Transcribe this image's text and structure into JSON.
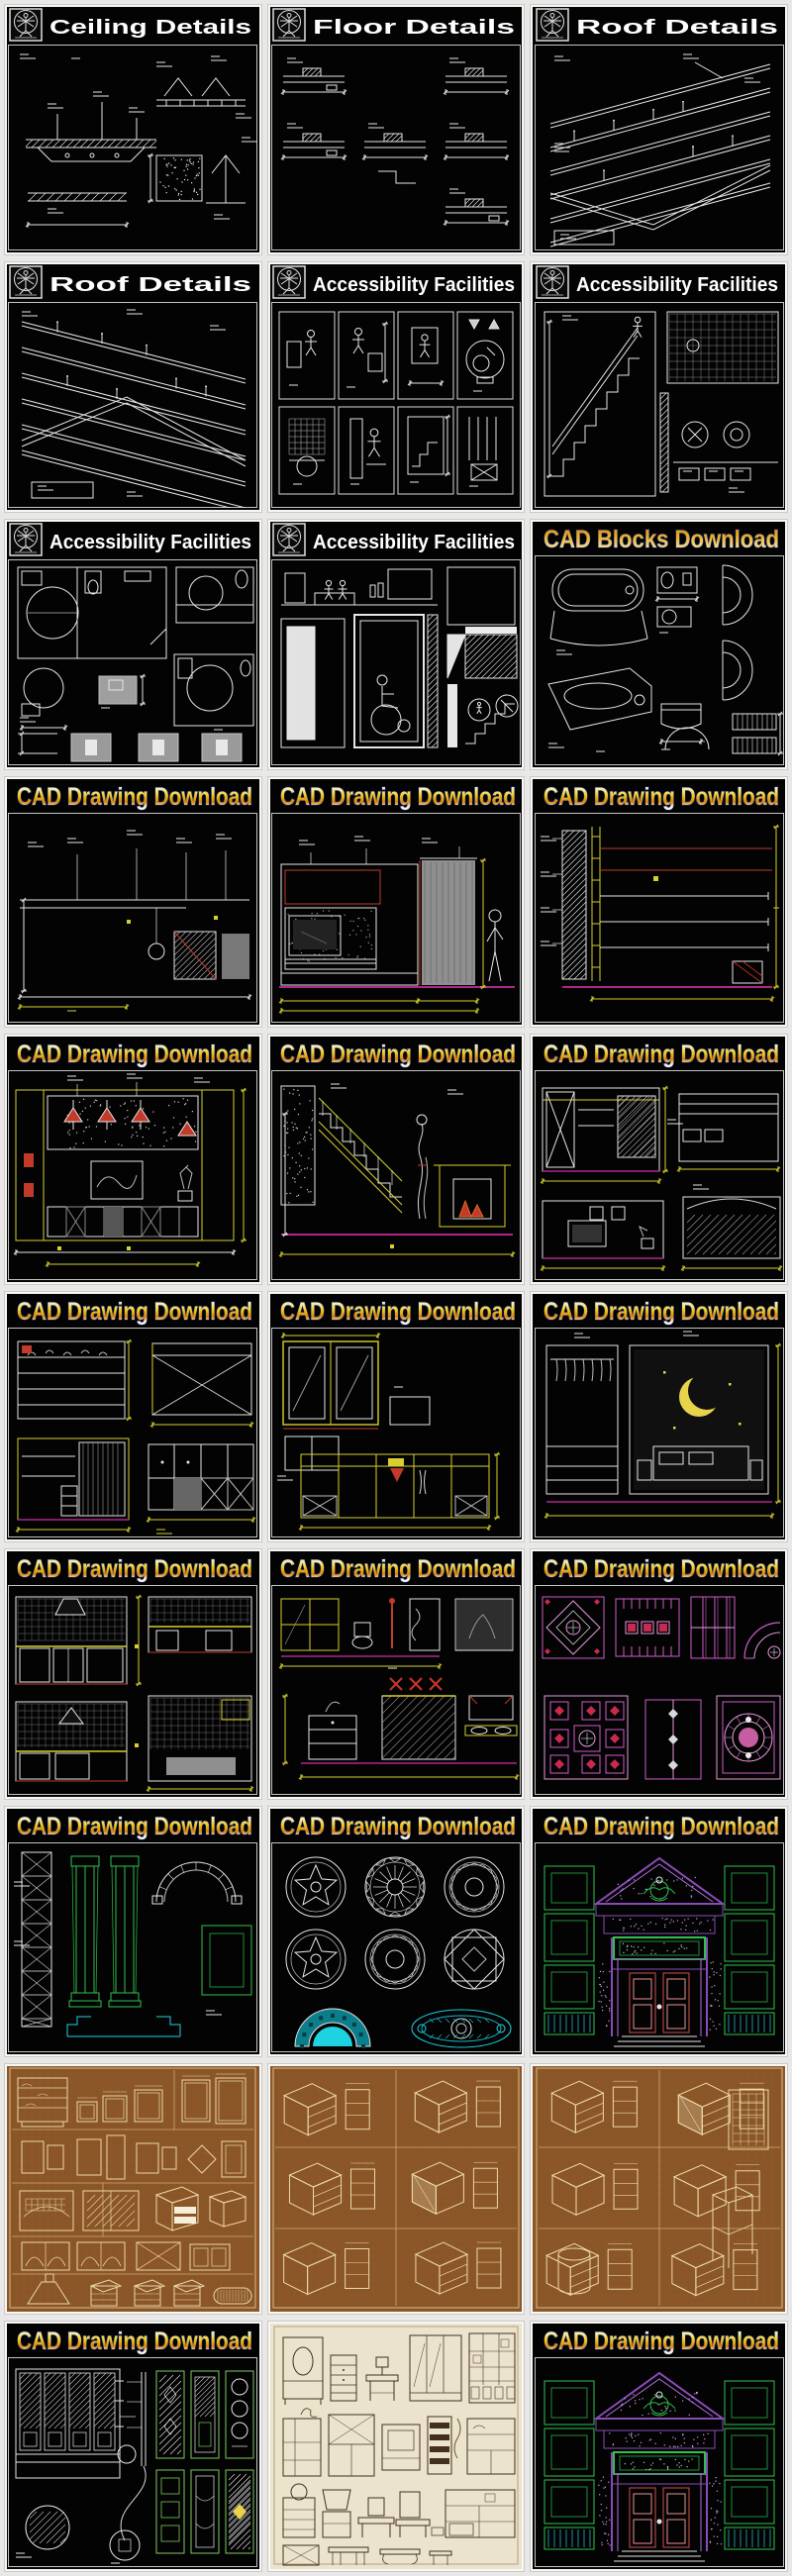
{
  "page": {
    "background": "#e9e8e6",
    "columns": 3,
    "rows": 10,
    "tile_count": 30
  },
  "palette": {
    "tile_bg_dark": "#030303",
    "tile_bg_brown": "#8a5527",
    "tile_bg_cream": "#ece3cd",
    "tile_border": "#f7f7f5",
    "tile_edge": "#bdbdbd",
    "line_white": "#e6e6e6",
    "line_gray": "#9a9a9a",
    "cad_yellow": "#d6cf2e",
    "cad_red": "#c8362a",
    "cad_magenta": "#b0268c",
    "cad_pink": "#cf5ec8",
    "cad_pink_light": "#e59ade",
    "cad_green": "#2fc14c",
    "cad_cyan": "#1ed2e2",
    "cad_purple": "#8a4bb8",
    "door_red": "#cf4f4f",
    "brown_line": "#ecd9a8",
    "brown_grid": "#94612e",
    "brown_divider": "#cfa96f",
    "cream_line": "#42301c",
    "title_white": "#ffffff",
    "title_outline": "#1b2a6e",
    "moon_yellow": "#e8d44a",
    "curtain_gray": "#8f8f8f"
  },
  "logo": {
    "name": "architect-logo",
    "shape": "vitruvian-man-in-square"
  },
  "tiles": [
    {
      "title": "Ceiling Details",
      "header": "logo",
      "art": "ceiling",
      "bg": "dark"
    },
    {
      "title": "Floor Details",
      "header": "logo",
      "art": "floor",
      "bg": "dark"
    },
    {
      "title": "Roof Details",
      "header": "logo",
      "art": "roofIso",
      "bg": "dark"
    },
    {
      "title": "Roof Details",
      "header": "logo",
      "art": "roofIso2",
      "bg": "dark"
    },
    {
      "title": "Accessibility Facilities",
      "header": "logo",
      "art": "accessPanels",
      "bg": "dark"
    },
    {
      "title": "Accessibility Facilities",
      "header": "logo",
      "art": "accessStairs",
      "bg": "dark"
    },
    {
      "title": "Accessibility Facilities",
      "header": "logo",
      "art": "accessPlan",
      "bg": "dark"
    },
    {
      "title": "Accessibility Facilities",
      "header": "logo",
      "art": "accessLift",
      "bg": "dark"
    },
    {
      "title": "CAD Blocks Download",
      "header": "gradientBlocks",
      "art": "blocks",
      "bg": "dark"
    },
    {
      "title": "CAD Drawing Download",
      "header": "gradient",
      "art": "elevSparse",
      "bg": "dark"
    },
    {
      "title": "CAD Drawing Download",
      "header": "gradient",
      "art": "elevTV",
      "bg": "dark"
    },
    {
      "title": "CAD Drawing Download",
      "header": "gradient",
      "art": "elevSection",
      "bg": "dark"
    },
    {
      "title": "CAD Drawing Download",
      "header": "gradient",
      "art": "elevLamps",
      "bg": "dark"
    },
    {
      "title": "CAD Drawing Download",
      "header": "gradient",
      "art": "stairHall",
      "bg": "dark"
    },
    {
      "title": "CAD Drawing Download",
      "header": "gradient",
      "art": "elevBedroom",
      "bg": "dark"
    },
    {
      "title": "CAD Drawing Download",
      "header": "gradient",
      "art": "elevCabinets",
      "bg": "dark"
    },
    {
      "title": "CAD Drawing Download",
      "header": "gradient",
      "art": "elevWardrobe",
      "bg": "dark"
    },
    {
      "title": "CAD Drawing Download",
      "header": "gradient",
      "art": "elevMoon",
      "bg": "dark"
    },
    {
      "title": "CAD Drawing Download",
      "header": "gradient",
      "art": "kitchen",
      "bg": "dark"
    },
    {
      "title": "CAD Drawing Download",
      "header": "gradient",
      "art": "bathroom",
      "bg": "dark"
    },
    {
      "title": "CAD Drawing Download",
      "header": "gradient",
      "art": "ceilingPlans",
      "bg": "dark"
    },
    {
      "title": "CAD Drawing Download",
      "header": "gradient",
      "art": "columns",
      "bg": "dark"
    },
    {
      "title": "CAD Drawing Download",
      "header": "gradient",
      "art": "medallions",
      "bg": "dark"
    },
    {
      "title": "CAD Drawing Download",
      "header": "gradient",
      "art": "facade",
      "bg": "dark"
    },
    {
      "title": "",
      "header": "none",
      "art": "brownCabinets",
      "bg": "brown"
    },
    {
      "title": "",
      "header": "none",
      "art": "brownIso",
      "bg": "brown"
    },
    {
      "title": "",
      "header": "none",
      "art": "brownIso2",
      "bg": "brown"
    },
    {
      "title": "CAD Drawing Download",
      "header": "gradient",
      "art": "lattice",
      "bg": "dark"
    },
    {
      "title": "",
      "header": "none",
      "art": "furnitureSheet",
      "bg": "cream"
    },
    {
      "title": "CAD Drawing Download",
      "header": "gradient",
      "art": "facade2",
      "bg": "dark"
    }
  ]
}
